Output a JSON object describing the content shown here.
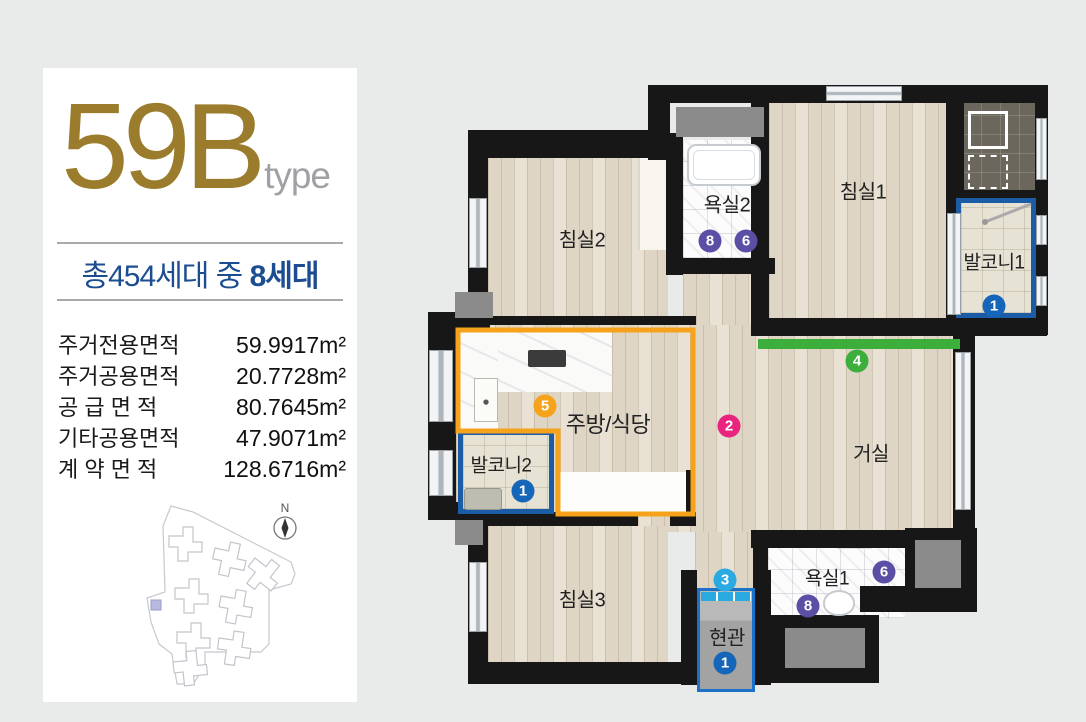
{
  "panel": {
    "type_number": "59B",
    "type_suffix": "type",
    "households_prefix": "총454세대 중 ",
    "households_bold": "8세대",
    "area_table": [
      {
        "label": "주거전용면적",
        "value": "59.9917m²"
      },
      {
        "label": "주거공용면적",
        "value": "20.7728m²"
      },
      {
        "label": "공 급 면 적",
        "value": "80.7645m²"
      },
      {
        "label": "기타공용면적",
        "value": "47.9071m²"
      },
      {
        "label": "계 약 면 적",
        "value": "128.6716m²"
      }
    ],
    "compass_label": "N"
  },
  "floor_plan": {
    "rooms": [
      {
        "name": "bedroom2",
        "label": "침실2"
      },
      {
        "name": "bathroom2",
        "label": "욕실2"
      },
      {
        "name": "bedroom1",
        "label": "침실1"
      },
      {
        "name": "balcony1",
        "label": "발코니1"
      },
      {
        "name": "kitchen-dining",
        "label": "주방/식당"
      },
      {
        "name": "living-room",
        "label": "거실"
      },
      {
        "name": "balcony2",
        "label": "발코니2"
      },
      {
        "name": "bedroom3",
        "label": "침실3"
      },
      {
        "name": "bathroom1",
        "label": "욕실1"
      },
      {
        "name": "entrance",
        "label": "현관"
      }
    ],
    "badges": [
      {
        "num": "8",
        "color": "#5B4FA5",
        "location": "bathroom2"
      },
      {
        "num": "6",
        "color": "#5B4FA5",
        "location": "bathroom2"
      },
      {
        "num": "1",
        "color": "#1565B8",
        "location": "balcony1"
      },
      {
        "num": "4",
        "color": "#3BAE3C",
        "location": "living-room-wall"
      },
      {
        "num": "2",
        "color": "#E8247E",
        "location": "hallway"
      },
      {
        "num": "5",
        "color": "#F6A21B",
        "location": "kitchen-dining"
      },
      {
        "num": "1",
        "color": "#1565B8",
        "location": "balcony2"
      },
      {
        "num": "6",
        "color": "#5B4FA5",
        "location": "bathroom1"
      },
      {
        "num": "8",
        "color": "#5B4FA5",
        "location": "bathroom1"
      },
      {
        "num": "3",
        "color": "#2BA9E1",
        "location": "entrance-door"
      },
      {
        "num": "1",
        "color": "#1565B8",
        "location": "entrance"
      }
    ],
    "colors": {
      "wall": "#171717",
      "wood_floor": "#E9E1D3",
      "kitchen_outline": "#F6A21B",
      "balcony_outline": "#1A5DA6",
      "entrance_outline": "#1B72C8",
      "green_bar": "#3BAE3C",
      "title_gold": "#9A7C2C",
      "households_blue": "#1B4D90"
    }
  }
}
